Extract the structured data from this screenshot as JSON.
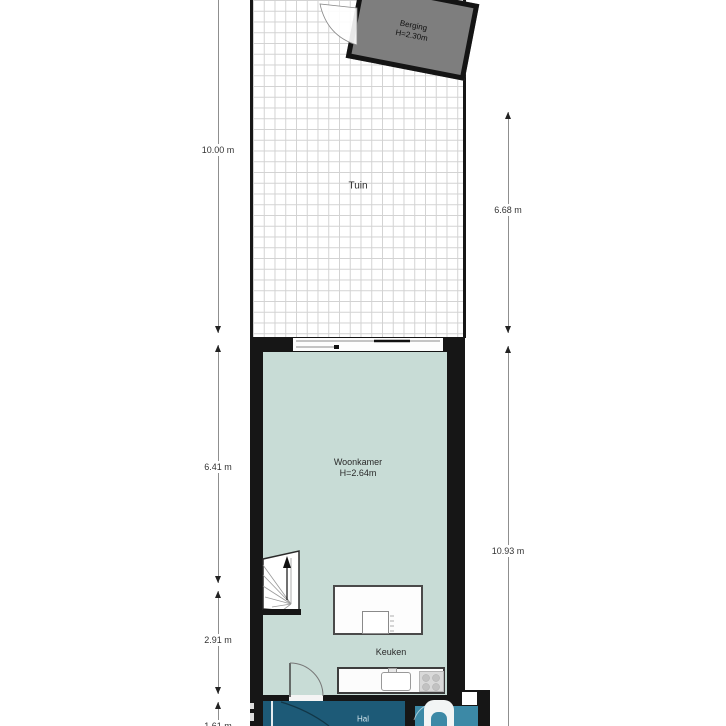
{
  "floorplan": {
    "rooms": {
      "tuin": {
        "label": "Tuin"
      },
      "berging": {
        "label": "Berging",
        "height": "H=2.30m"
      },
      "woonkamer": {
        "label": "Woonkamer",
        "height": "H=2.64m"
      },
      "keuken": {
        "label": "Keuken"
      },
      "hal": {
        "label": "Hal"
      }
    },
    "dimensions": {
      "left_garden": "10.00 m",
      "left_woonkamer": "6.41 m",
      "left_keuken": "2.91 m",
      "left_hal": "1.61 m",
      "right_garden": "6.68 m",
      "right_house": "10.93 m"
    },
    "colors": {
      "wall": "#161616",
      "woonkamer_fill": "#c8dcd6",
      "hal_fill": "#1d5a77",
      "toilet_fill": "#3c89a6",
      "berging_fill": "#7e7e7e",
      "grid_line": "#d2d2d2"
    }
  }
}
